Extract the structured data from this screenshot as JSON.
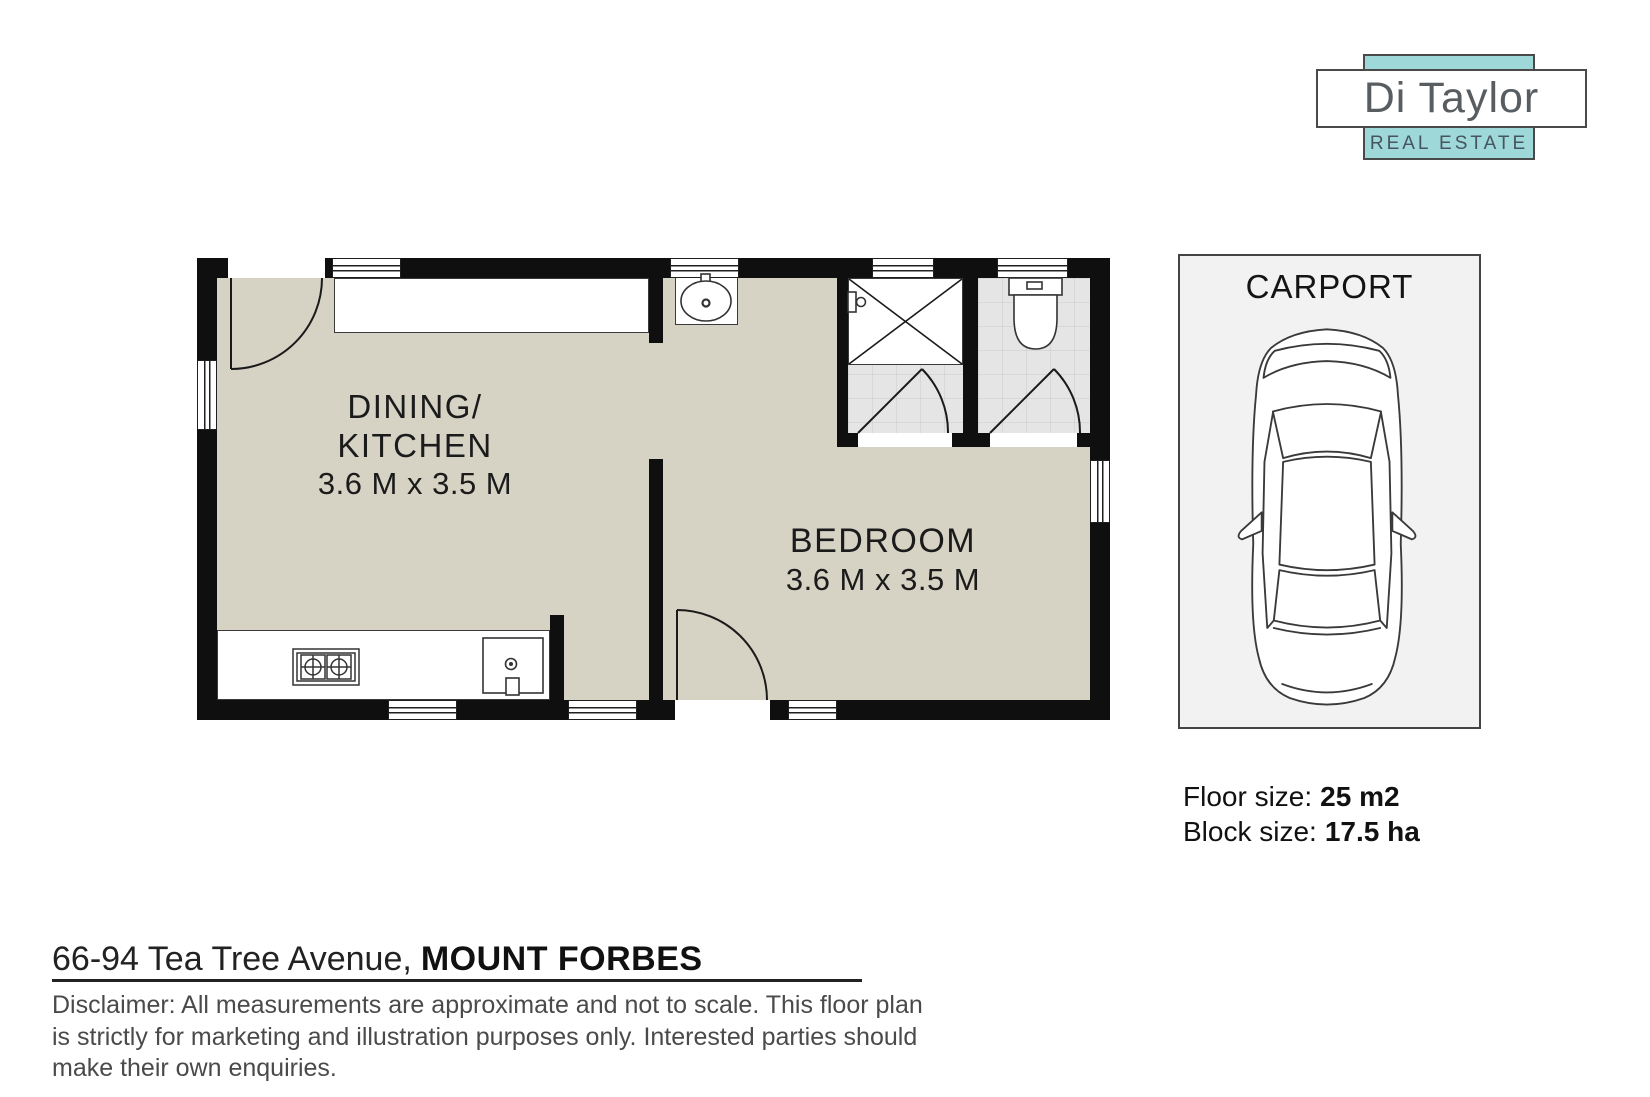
{
  "brand": {
    "name": "Di Taylor",
    "tagline": "REAL ESTATE",
    "accent_teal": "#9ed8d8",
    "border_gray": "#4a4a4a"
  },
  "carport": {
    "label": "CARPORT"
  },
  "floorplan": {
    "wall_color": "#0f0f0f",
    "floor_color": "#d6d2c4",
    "tile_color": "#e5e5e5",
    "rooms": [
      {
        "id": "dining-kitchen",
        "label_line1": "DINING/",
        "label_line2": "KITCHEN",
        "dimensions": "3.6 M x 3.5 M"
      },
      {
        "id": "bedroom",
        "label": "BEDROOM",
        "dimensions": "3.6 M x 3.5 M"
      }
    ]
  },
  "property": {
    "floor_size_label": "Floor size:",
    "floor_size_value": "25 m2",
    "block_size_label": "Block size:",
    "block_size_value": "17.5 ha",
    "address_street": "66-94 Tea Tree Avenue,",
    "address_locality": "MOUNT FORBES"
  },
  "disclaimer": {
    "line1": "Disclaimer: All measurements are approximate and not to scale. This floor plan",
    "line2": "is strictly for marketing and illustration purposes only. Interested parties should",
    "line3": "make their own enquiries."
  }
}
